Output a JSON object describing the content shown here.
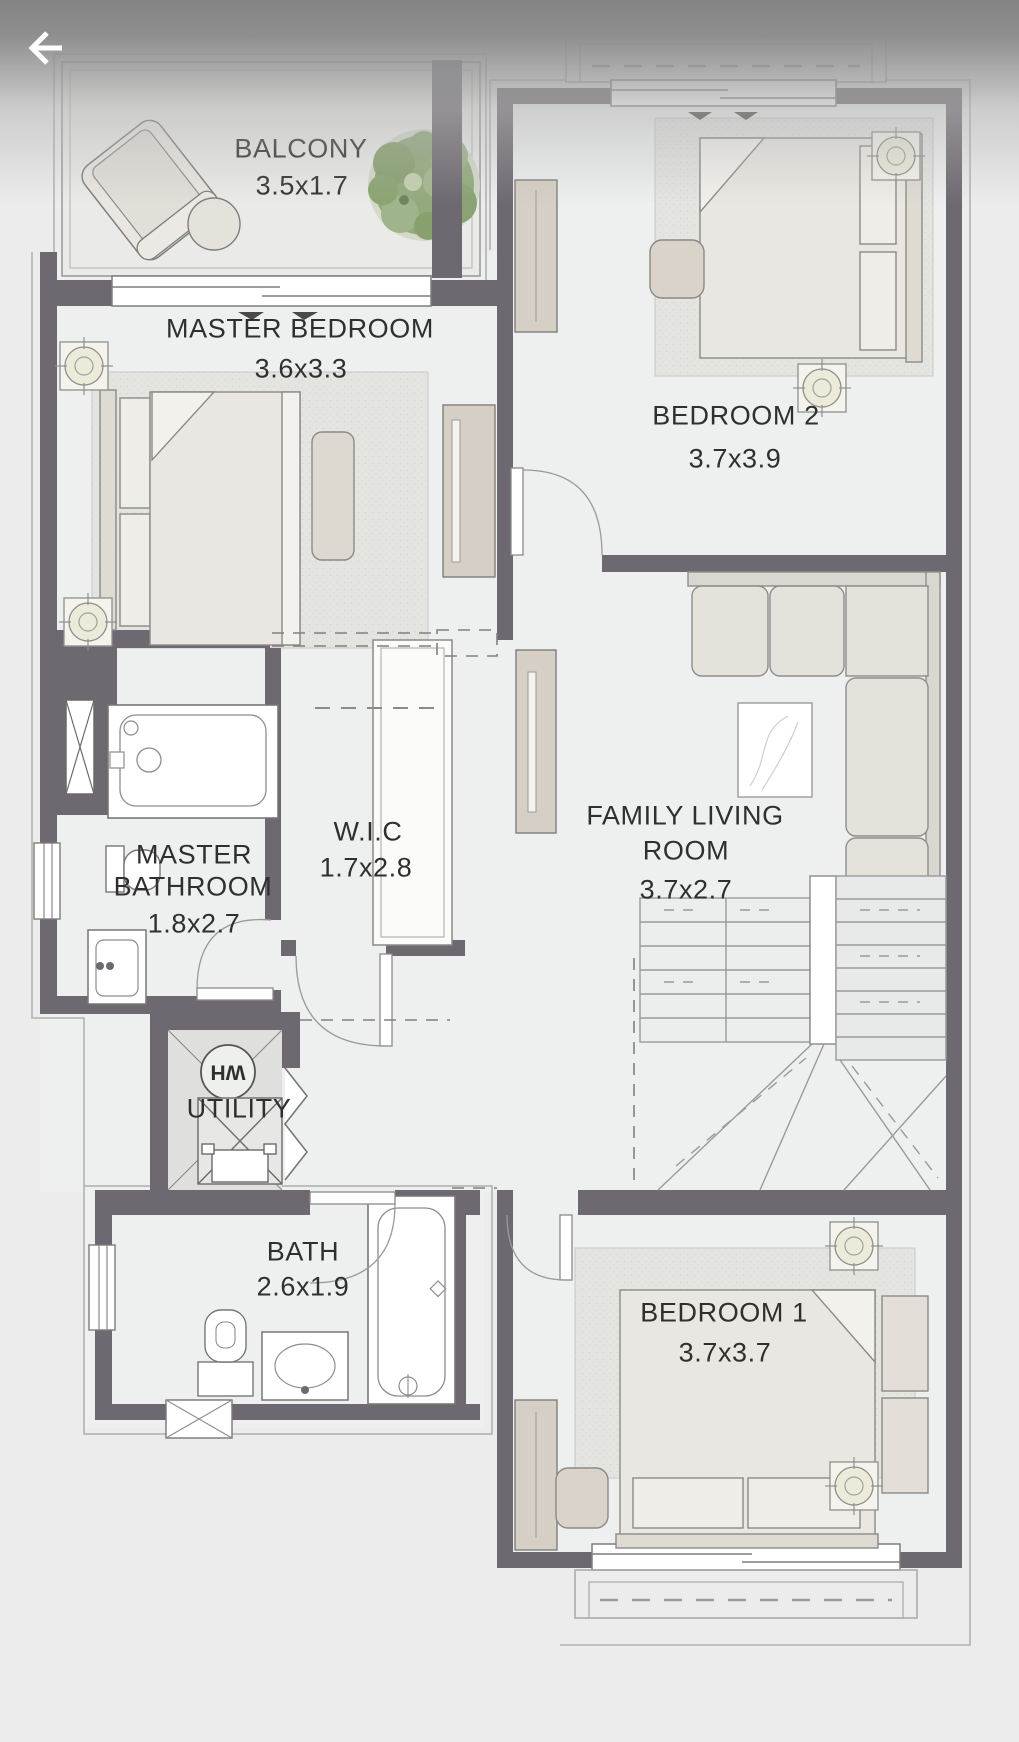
{
  "header": {
    "back_icon": "arrow-left-icon"
  },
  "plan": {
    "balcony": {
      "name": "BALCONY",
      "dims": "3.5x1.7"
    },
    "master_bedroom": {
      "name": "MASTER BEDROOM",
      "dims": "3.6x3.3"
    },
    "bedroom_2": {
      "name": "BEDROOM 2",
      "dims": "3.7x3.9"
    },
    "master_bathroom": {
      "name_line1": "MASTER",
      "name_line2": "BATHROOM",
      "dims": "1.8x2.7"
    },
    "wic": {
      "name": "W.I.C",
      "dims": "1.7x2.8"
    },
    "family_living_room": {
      "name_line1": "FAMILY LIVING",
      "name_line2": "ROOM",
      "dims": "3.7x2.7"
    },
    "utility": {
      "name": "UTILITY",
      "water_heater_label": "WH"
    },
    "bath": {
      "name": "BATH",
      "dims": "2.6x1.9"
    },
    "bedroom_1": {
      "name": "BEDROOM 1",
      "dims": "3.7x3.7"
    }
  },
  "colors": {
    "wall": "#6e6971",
    "floor": "#eef0ef",
    "text": "#2f2f2f",
    "tree": "#93aa7c",
    "wood": "#d6cfc5"
  }
}
